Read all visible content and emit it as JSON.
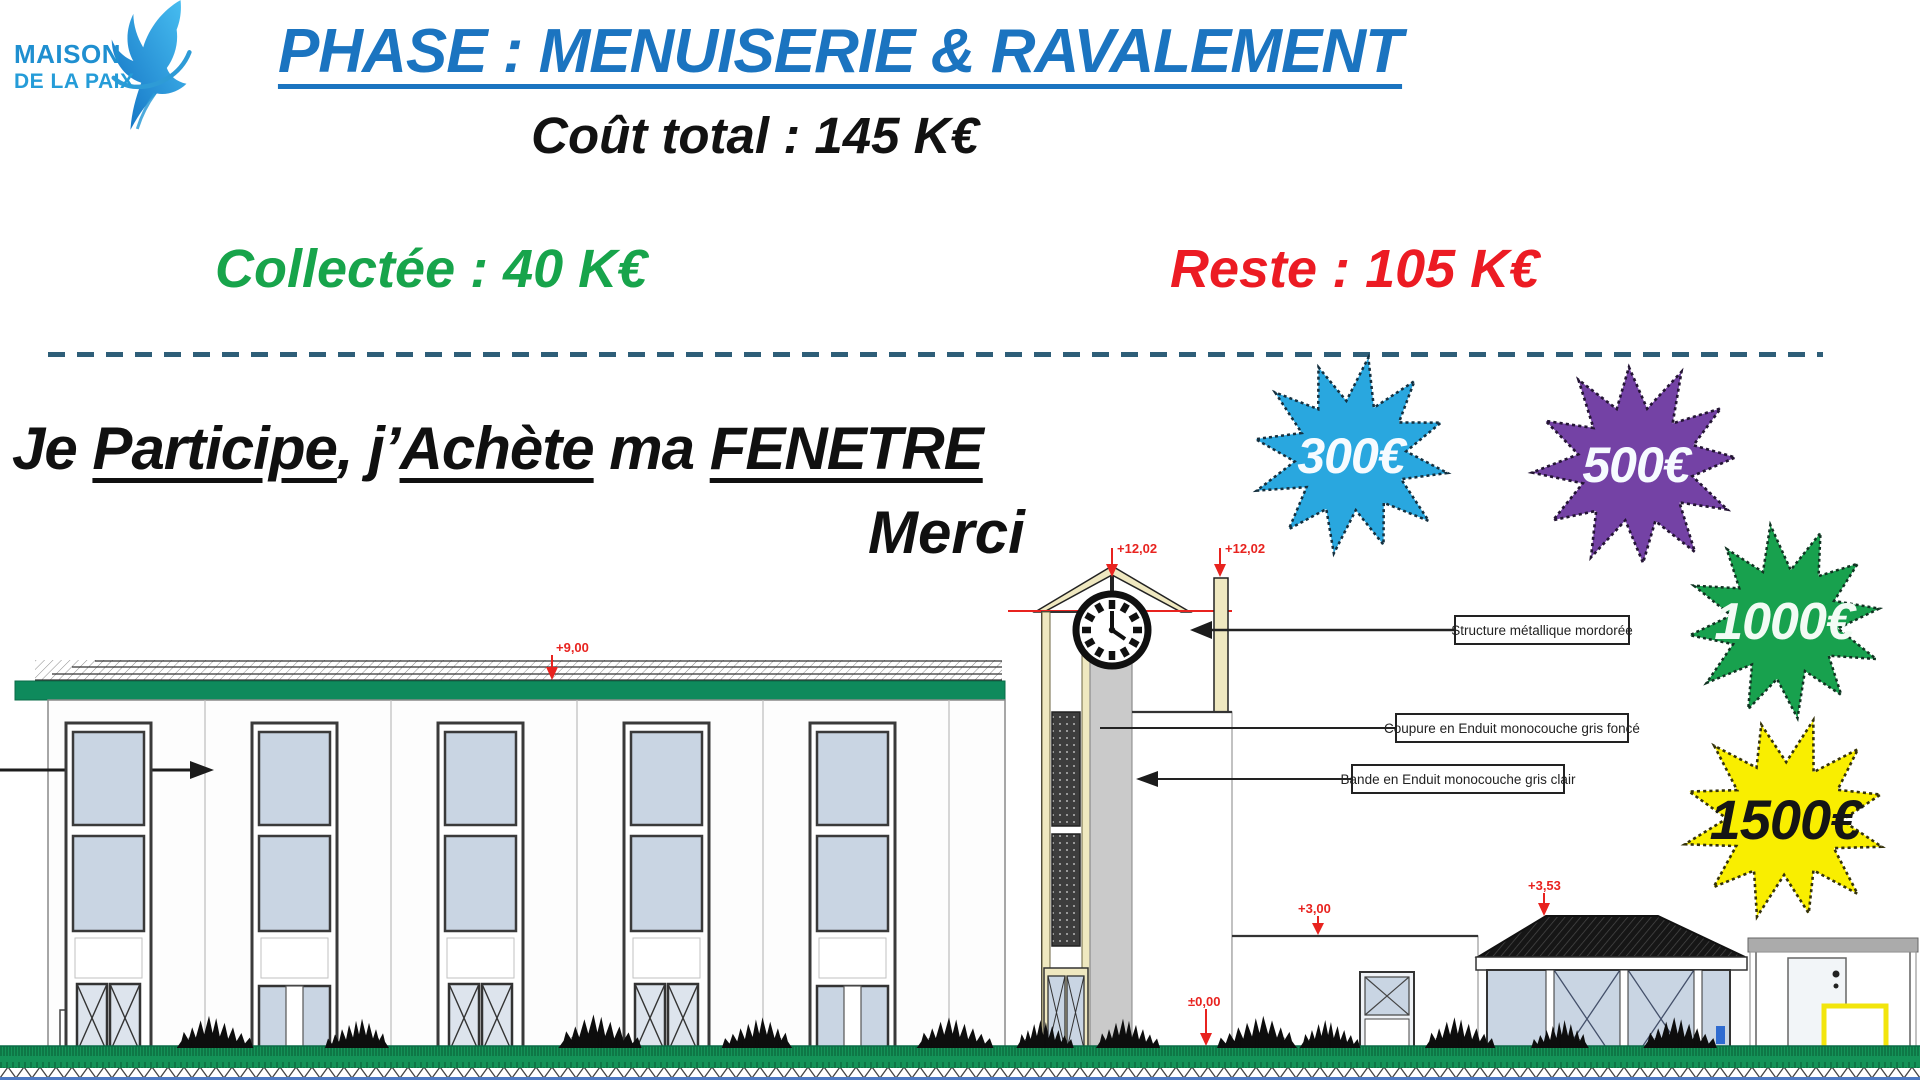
{
  "logo": {
    "line1": "MAISON",
    "line2": "DE LA PAIX"
  },
  "header": {
    "title": "PHASE : MENUISERIE & RAVALEMENT",
    "total": "Coût total : 145 K€",
    "collected": "Collectée : 40 K€",
    "remaining": "Reste : 105 K€"
  },
  "appeal": {
    "p1": "Je ",
    "p2": "Participe",
    "p3": ", j’",
    "p4": "Achète",
    "p5": " ma ",
    "p6": "FENETRE",
    "thanks": "Merci"
  },
  "donation_stars": [
    {
      "amount": "300€",
      "color": "#29a7df"
    },
    {
      "amount": "500€",
      "color": "#7442a5"
    },
    {
      "amount": "1000€",
      "color": "#18a14e"
    },
    {
      "amount": "1500€",
      "color": "#f9ee00"
    }
  ],
  "drawing": {
    "callouts": {
      "c1": "Structure métallique mordorée",
      "c2": "Coupure en Enduit monocouche gris foncé",
      "c3": "Bande en Enduit monocouche gris clair"
    },
    "levels": {
      "ridge_a": "+12,02",
      "ridge_b": "+12,02",
      "roof": "+9,00",
      "annex": "+3,00",
      "porch": "+3,53",
      "ground": "±0,00"
    }
  },
  "palette": {
    "title_blue": "#1b74c0",
    "collected_green": "#17a44b",
    "remaining_red": "#ec1b23",
    "divider_blue": "#2e5e78",
    "logo_blue": "#1f8fd0",
    "annotation_red": "#e8231f",
    "bottom_line_blue": "#4c78c2"
  }
}
